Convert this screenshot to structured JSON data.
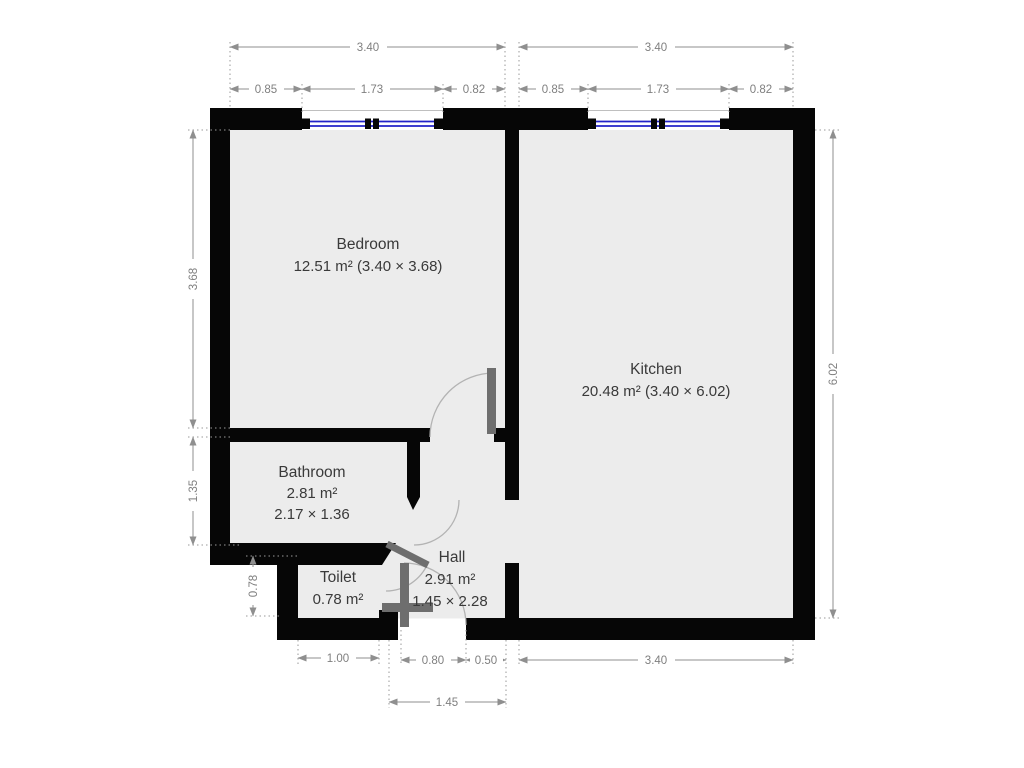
{
  "plan_title": "Apartment floor plan",
  "rooms": {
    "bedroom": {
      "name": "Bedroom",
      "details": "12.51 m² (3.40 × 3.68)"
    },
    "kitchen": {
      "name": "Kitchen",
      "details": "20.48 m² (3.40 × 6.02)"
    },
    "bathroom": {
      "name": "Bathroom",
      "area": "2.81 m²",
      "size": "2.17 × 1.36"
    },
    "toilet": {
      "name": "Toilet",
      "area": "0.78 m²"
    },
    "hall": {
      "name": "Hall",
      "area": "2.91 m²",
      "size": "1.45 × 2.28"
    }
  },
  "dims": {
    "bedroom_width_total": "3.40",
    "bedroom_seg_left": "0.85",
    "bedroom_seg_window": "1.73",
    "bedroom_seg_right": "0.82",
    "kitchen_width_total": "3.40",
    "kitchen_seg_left": "0.85",
    "kitchen_seg_window": "1.73",
    "kitchen_seg_right": "0.82",
    "bedroom_height": "3.68",
    "bathroom_height": "1.35",
    "toilet_height": "0.78",
    "kitchen_height": "6.02",
    "toilet_width": "1.00",
    "entry_door_width": "0.80",
    "entry_side_gap": "0.50",
    "hall_width": "1.45",
    "kitchen_width_bottom": "3.40"
  },
  "colors": {
    "wall": "#060606",
    "floor": "#ececec",
    "window_glass": "#2323c8",
    "door_leaf": "#6e6e6e",
    "dimension_text": "#7f7f7f",
    "room_text": "#3a3a3a",
    "background": "#ffffff"
  }
}
